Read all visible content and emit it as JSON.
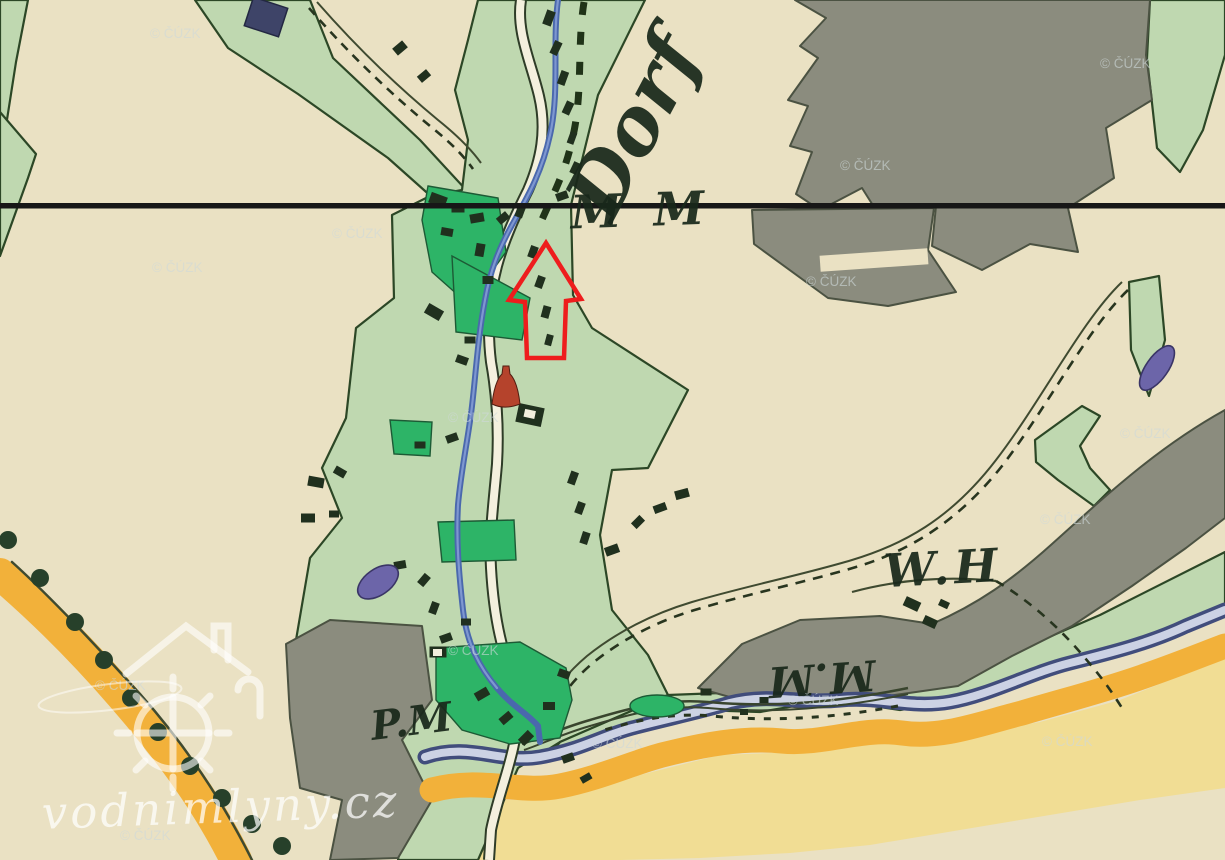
{
  "map": {
    "title": "Historical cadastral map sheet",
    "labels": {
      "village_rotated": "Dorf",
      "line_label": "M M",
      "wh_label": "W.H",
      "mm_label": "M.M",
      "pm_label": "P.M"
    },
    "watermarks": {
      "cuzk": "© ČÚZK",
      "site": "vodnimlyny.cz"
    },
    "annotation": {
      "type": "arrow-up",
      "color": "#ee1d1d"
    },
    "colors": {
      "paper": "#eae1c3",
      "meadow_green": "#bfd8b0",
      "garden_green": "#2db467",
      "forest_gray": "#8b8c7e",
      "road_yellow": "#f2b13a",
      "field_yellow": "#f1dd94",
      "river_navy": "#414d7c",
      "river_fill": "#ccd2e4",
      "stream_blue": "#4a68ad",
      "pond_purple": "#6c65a9",
      "building_dark": "#20301e",
      "church_red": "#b5432c",
      "survey_line": "#171717",
      "outline_green": "#2c4726",
      "ink": "#19281b",
      "road_fill": "#f4f0de"
    }
  }
}
